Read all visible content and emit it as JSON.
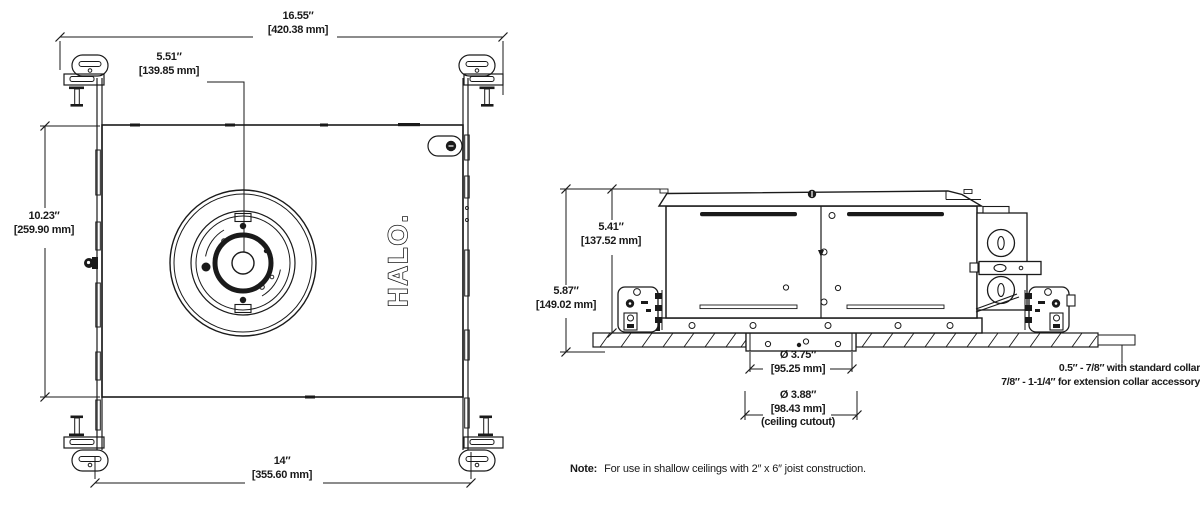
{
  "title": "HALO recessed housing dimensional drawing",
  "colors": {
    "ink": "#1a1a1a",
    "background": "#ffffff"
  },
  "plan_view": {
    "logo": "HALO.",
    "dims": {
      "overall_width": {
        "inches": "16.55″",
        "mm": "[420.38 mm]"
      },
      "aperture_offset": {
        "inches": "5.51″",
        "mm": "[139.85 mm]"
      },
      "pan_height": {
        "inches": "10.23″",
        "mm": "[259.90 mm]"
      },
      "pan_width": {
        "inches": "14″",
        "mm": "[355.60 mm]"
      }
    }
  },
  "side_view": {
    "dims": {
      "housing_height": {
        "inches": "5.41″",
        "mm": "[137.52 mm]"
      },
      "overall_height": {
        "inches": "5.87″",
        "mm": "[149.02 mm]"
      },
      "collar_diameter": {
        "inches": "Ø 3.75″",
        "mm": "[95.25 mm]"
      },
      "ceiling_cutout": {
        "inches": "Ø 3.88″",
        "mm": "[98.43 mm]",
        "caption": "(ceiling cutout)"
      }
    },
    "collar_note": {
      "line1": "0.5″ - 7/8″ with standard collar",
      "line2": "7/8″ - 1-1/4″ for extension collar accessory"
    }
  },
  "footnote": {
    "label": "Note:",
    "text": "For use in shallow ceilings with 2″ x 6″ joist construction."
  }
}
